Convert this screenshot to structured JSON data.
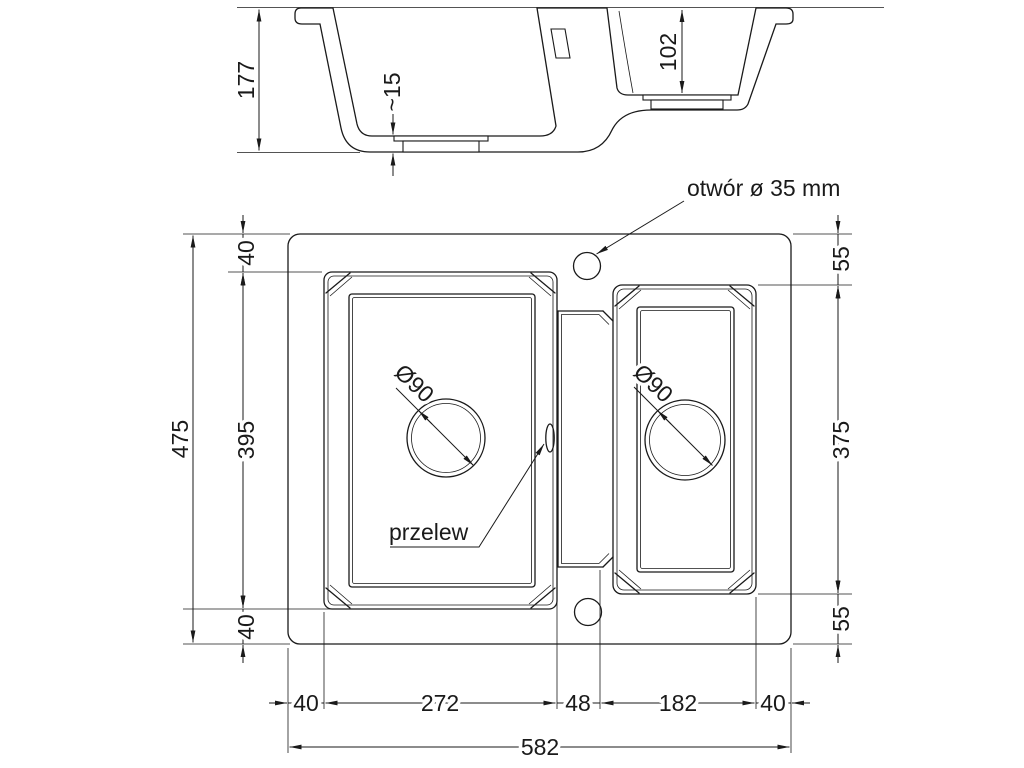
{
  "drawing_title": "sink-technical-drawing",
  "colors": {
    "line": "#1a1a1a",
    "background": "#ffffff"
  },
  "section": {
    "total_depth": "177",
    "floor_thickness": "~15",
    "small_bowl_depth": "102"
  },
  "plan": {
    "tap_hole_label": "otwór ø 35 mm",
    "overflow_label": "przelew",
    "main_drain_diameter": "Ø90",
    "small_drain_diameter": "Ø90",
    "left_chain": {
      "total": "475",
      "top": "40",
      "middle": "395",
      "bottom": "40"
    },
    "right_chain": {
      "top": "55",
      "middle": "375",
      "bottom": "55"
    },
    "bottom_chain": {
      "left_margin": "40",
      "main_bowl": "272",
      "divider": "48",
      "small_bowl": "182",
      "right_margin": "40",
      "total": "582"
    }
  }
}
